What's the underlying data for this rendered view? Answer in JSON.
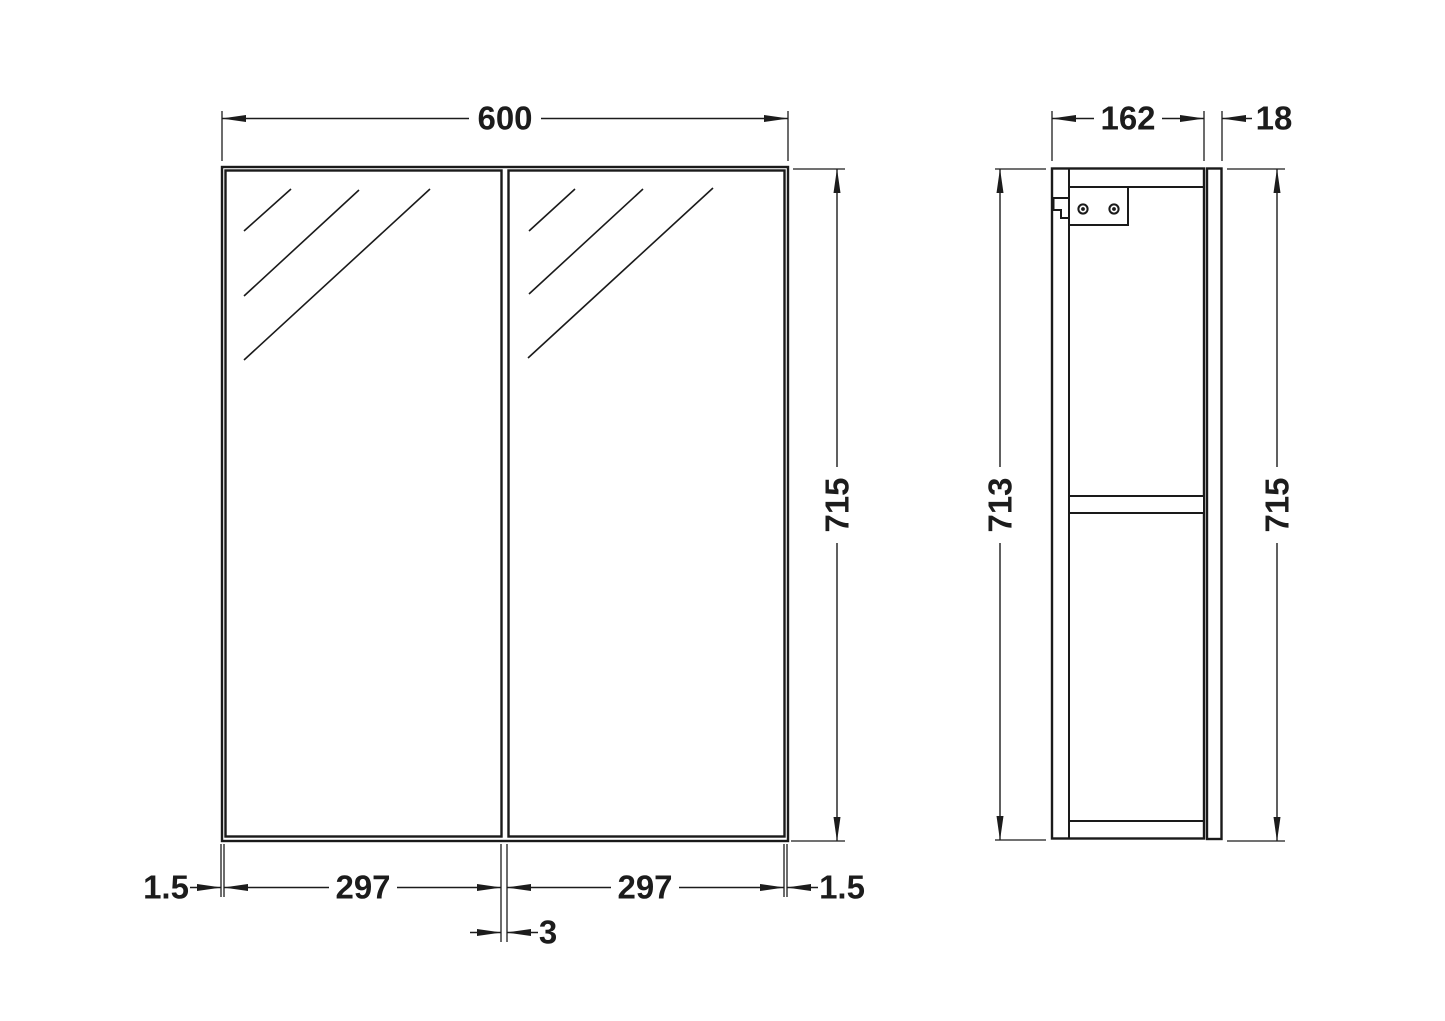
{
  "drawing": {
    "type": "technical-dimension-drawing",
    "subject": "double-door-mirror-cabinet",
    "colors": {
      "line": "#1a1a1a",
      "dimension": "#1c1c1c",
      "background": "#ffffff"
    },
    "front_view": {
      "width_label": "600",
      "height_label": "715",
      "left_gap_label": "1.5",
      "left_door_width_label": "297",
      "right_door_width_label": "297",
      "right_gap_label": "1.5",
      "center_gap_label": "3"
    },
    "side_view": {
      "depth_label": "162",
      "door_thickness_label": "18",
      "carcass_height_label": "713",
      "door_height_label": "715"
    }
  }
}
